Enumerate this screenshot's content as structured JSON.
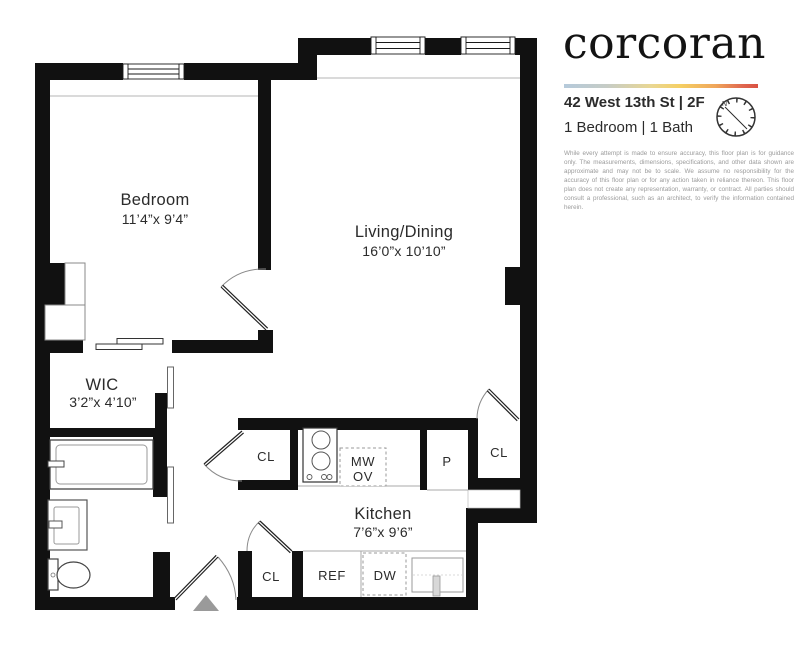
{
  "brand": {
    "logo_text": "corcoran"
  },
  "listing": {
    "address": "42 West 13th St | 2F",
    "summary": "1 Bedroom | 1 Bath"
  },
  "compass": {
    "north": "N"
  },
  "disclaimer": "While every attempt is made to ensure accuracy, this floor plan is for guidance only. The measurements, dimensions, specifications, and other data shown are approximate and may not be to scale. We assume no responsibility for the accuracy of this floor plan or for any action taken in reliance thereon. This floor plan does not create any representation, warranty, or contract. All parties should consult a professional, such as an architect, to verify the information contained herein.",
  "floorplan": {
    "bedroom": {
      "name": "Bedroom",
      "dims": "11’4”x 9’4”"
    },
    "living": {
      "name": "Living/Dining",
      "dims": "16’0”x 10’10”"
    },
    "wic": {
      "name": "WIC",
      "dims": "3’2”x 4’10”"
    },
    "kitchen": {
      "name": "Kitchen",
      "dims": "7’6”x 9’6”"
    },
    "labels": {
      "closet": "CL",
      "pantry": "P",
      "microwave": "MW",
      "oven": "OV",
      "fridge": "REF",
      "dishwasher": "DW"
    }
  },
  "colors": {
    "wall": "#111111",
    "thin_line": "#aaaaaa",
    "entry_arrow": "#9a9a9a",
    "brand_gradient": [
      "#b5cadb",
      "#c6ccc6",
      "#e9d793",
      "#f5cf63",
      "#efa65b",
      "#d95142"
    ]
  }
}
